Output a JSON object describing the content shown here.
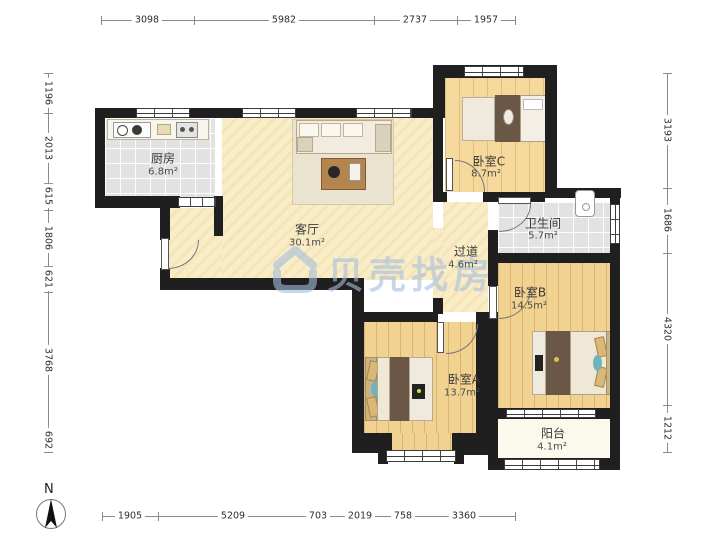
{
  "plan": {
    "type": "floorplan",
    "rooms": [
      {
        "id": "kitchen",
        "name": "厨房",
        "area": "6.8m²"
      },
      {
        "id": "living",
        "name": "客厅",
        "area": "30.1m²"
      },
      {
        "id": "bedroomC",
        "name": "卧室C",
        "area": "8.7m²"
      },
      {
        "id": "bathroom",
        "name": "卫生间",
        "area": "5.7m²"
      },
      {
        "id": "hallway",
        "name": "过道",
        "area": "4.6m²"
      },
      {
        "id": "bedroomB",
        "name": "卧室B",
        "area": "14.5m²"
      },
      {
        "id": "bedroomA",
        "name": "卧室A",
        "area": "13.7m²"
      },
      {
        "id": "balcony",
        "name": "阳台",
        "area": "4.1m²"
      }
    ],
    "dimensions": {
      "top": [
        "3098",
        "5982",
        "2737",
        "1957"
      ],
      "left": [
        "1196",
        "2013",
        "615",
        "1806",
        "621",
        "3768",
        "692"
      ],
      "right": [
        "3193",
        "1686",
        "4320",
        "1212"
      ],
      "bottom": [
        "1905",
        "5209",
        "703",
        "2019",
        "758",
        "3360"
      ]
    },
    "compass": {
      "label": "N"
    },
    "watermark": {
      "text": "贝壳找房",
      "logo": "beike-house-logo",
      "color": "#a6bedd"
    },
    "colors": {
      "wall": "#1f1f1f",
      "wood_floor": "#f2d291",
      "cream_floor": "#f9edc8",
      "tile_floor": "#e2e2e2",
      "balcony_floor": "#fbf8ec",
      "furniture_dark": "#6b5745",
      "pillow_tan": "#d9b878",
      "pillow_teal": "#6fb3bc",
      "watermark_blue": "#a6bedd"
    }
  }
}
